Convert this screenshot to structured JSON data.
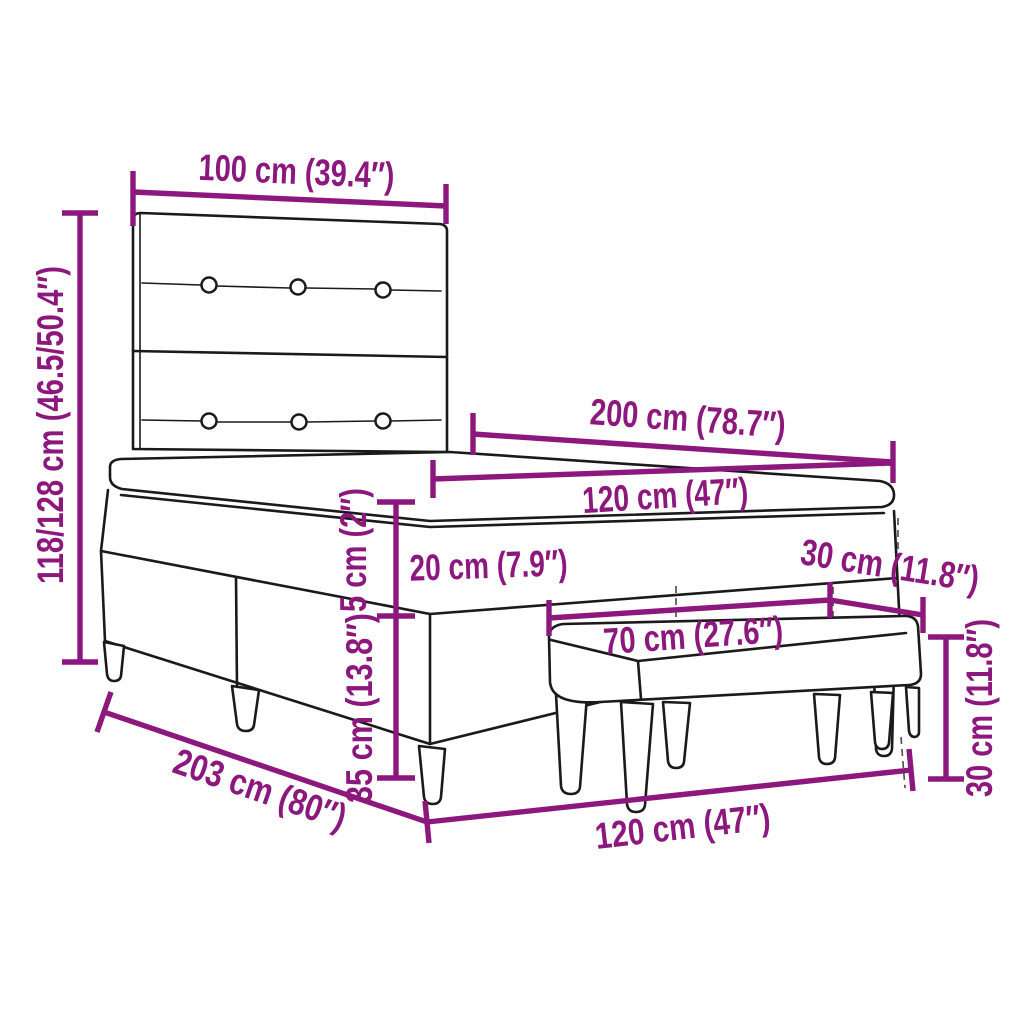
{
  "diagram": {
    "type": "product-dimension-diagram",
    "subject": "box-spring-bed-with-headboard-and-bench",
    "colors": {
      "dimension_accent": "#8D187D",
      "line_art": "#1A1A1A",
      "background": "#FFFFFF"
    },
    "dims": {
      "headboard_width": "100 cm (39.4″)",
      "headboard_height": "118/128 cm (46.5/50.4″)",
      "bed_length": "200 cm (78.7″)",
      "mattress_width": "120 cm (47″)",
      "mattress_height": "20 cm (7.9″)",
      "topper_height": "5 cm (2″)",
      "base_height": "35 cm (13.8″)",
      "base_length": "203 cm (80″)",
      "bed_width_bottom": "120 cm (47″)",
      "bench_length": "70 cm (27.6″)",
      "bench_depth": "30 cm (11.8″)",
      "bench_height": "30 cm (11.8″)"
    }
  }
}
